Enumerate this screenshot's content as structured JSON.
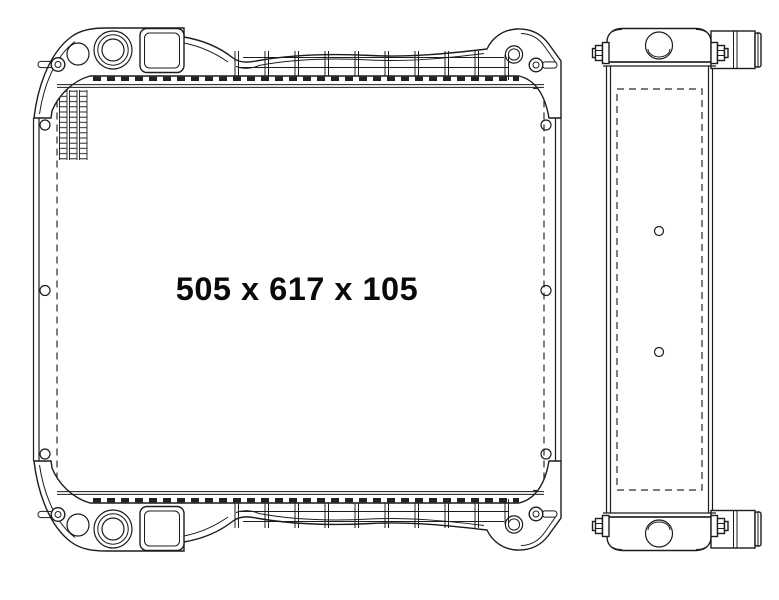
{
  "drawing": {
    "dimension_label": "505 x 617 x 105",
    "dimensions": {
      "width": "505",
      "height": "617",
      "depth": "105"
    },
    "colors": {
      "line": "#1c1c1c",
      "background": "#ffffff",
      "text": "#0a0a0a"
    }
  }
}
